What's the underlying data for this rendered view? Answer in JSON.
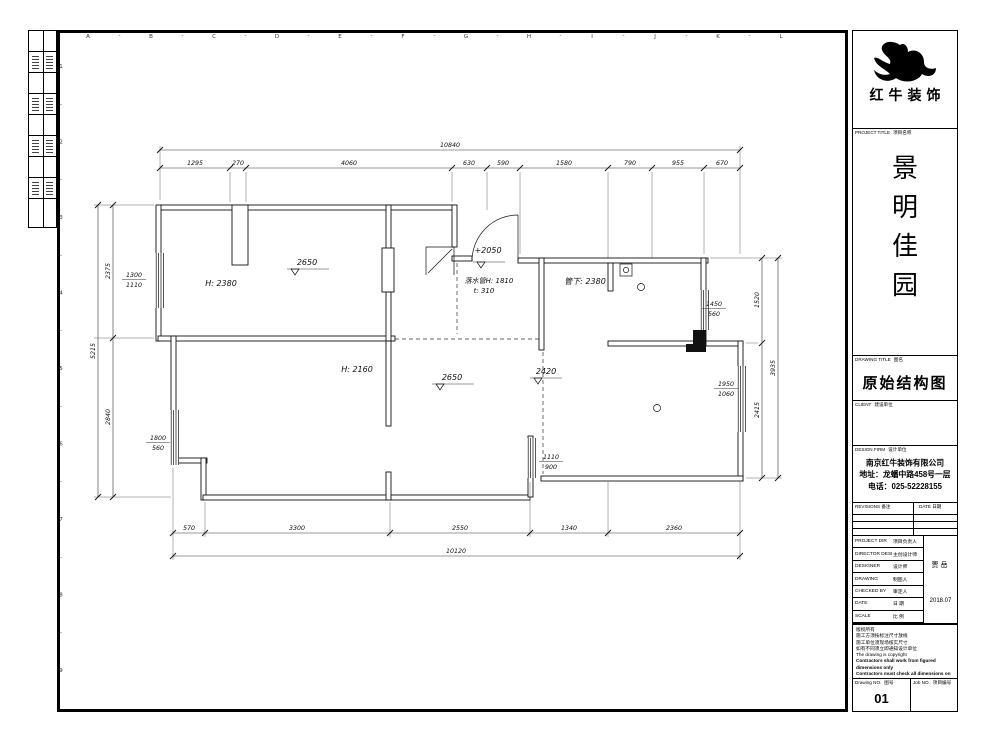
{
  "grid": {
    "letters": [
      "A",
      "B",
      "C",
      "D",
      "E",
      "F",
      "G",
      "H",
      "I",
      "J",
      "K",
      "L"
    ],
    "numbers": [
      "1",
      "2",
      "3",
      "4",
      "5",
      "6",
      "7",
      "8",
      "9"
    ]
  },
  "plan": {
    "labels": {
      "h_top_left": "H: 2380",
      "dim_top_left": "2650",
      "entry_level": "+2050",
      "entry_note_1": "落水管H: 1810",
      "entry_note_2": "t: 310",
      "pipe_note": "管下: 2380",
      "h_hall": "H: 2160",
      "dim_hall": "2650",
      "dim_hall_2": "2420"
    },
    "windows": [
      {
        "w": "1300",
        "h": "1110"
      },
      {
        "w": "1800",
        "h": "560"
      },
      {
        "w": "1110",
        "h": "900"
      },
      {
        "w": "1450",
        "h": "560"
      },
      {
        "w": "1950",
        "h": "1060"
      }
    ],
    "dims_top": {
      "overall": "10840",
      "segments": [
        "1295",
        "270",
        "4060",
        "630",
        "590",
        "1580",
        "790",
        "955",
        "670"
      ]
    },
    "dims_bottom": {
      "overall": "10120",
      "segments": [
        "570",
        "3300",
        "2550",
        "1340",
        "2360"
      ]
    },
    "dims_left": {
      "overall": "5215",
      "segments": [
        "2375",
        "2840"
      ]
    },
    "dims_right": {
      "overall": "3935",
      "segments": [
        "1520",
        "2415"
      ]
    }
  },
  "title_block": {
    "brand": "红牛装饰",
    "project": {
      "label_en": "PROJECT TITLE",
      "label_zh": "项目名称",
      "chars": [
        "景",
        "明",
        "佳",
        "园"
      ]
    },
    "drawing": {
      "label_en": "DRAWING TITLE",
      "label_zh": "图名",
      "title": "原始结构图"
    },
    "client": {
      "label_en": "CLIENT",
      "label_zh": "建设单位"
    },
    "firm": {
      "label_en": "DESIGN FIRM",
      "label_zh": "设计单位",
      "company": "南京红牛装饰有限公司",
      "address": "地址：龙蟠中路458号一层",
      "phone": "电话：025-52228155"
    },
    "revisions": {
      "label_en": "REVISIONS",
      "label_zh": "备注",
      "date_en": "DATE",
      "date_zh": "日期"
    },
    "rows": [
      {
        "en": "PROJECT DIR",
        "zh": "项目负责人"
      },
      {
        "en": "DIRECTOR DESI",
        "zh": "主创设计师"
      },
      {
        "en": "DESIGNER",
        "zh": "设计师"
      },
      {
        "en": "DRAWING",
        "zh": "制图人"
      },
      {
        "en": "CHECKED BY",
        "zh": "审定人"
      },
      {
        "en": "DATE",
        "zh": "日 期"
      },
      {
        "en": "SCALE",
        "zh": "比 例"
      }
    ],
    "designer_value": "贾岳",
    "date_value": "2018.07",
    "notes": [
      "版权所有",
      "施工方须按标注尺寸放线",
      "施工单位须现场核实尺寸",
      "如有不同须立即通知设计单位",
      "The drawing is copyright",
      "Contractors shall work from figured dimensions only",
      "Contractors must check all dimensions on site",
      "Contractors must be reported immediately to architects"
    ],
    "drawing_no": {
      "label_en": "Drawing NO.",
      "label_zh": "图号",
      "value": "01"
    },
    "job_no": {
      "label_en": "Job NO.",
      "label_zh": "项目编号"
    }
  }
}
